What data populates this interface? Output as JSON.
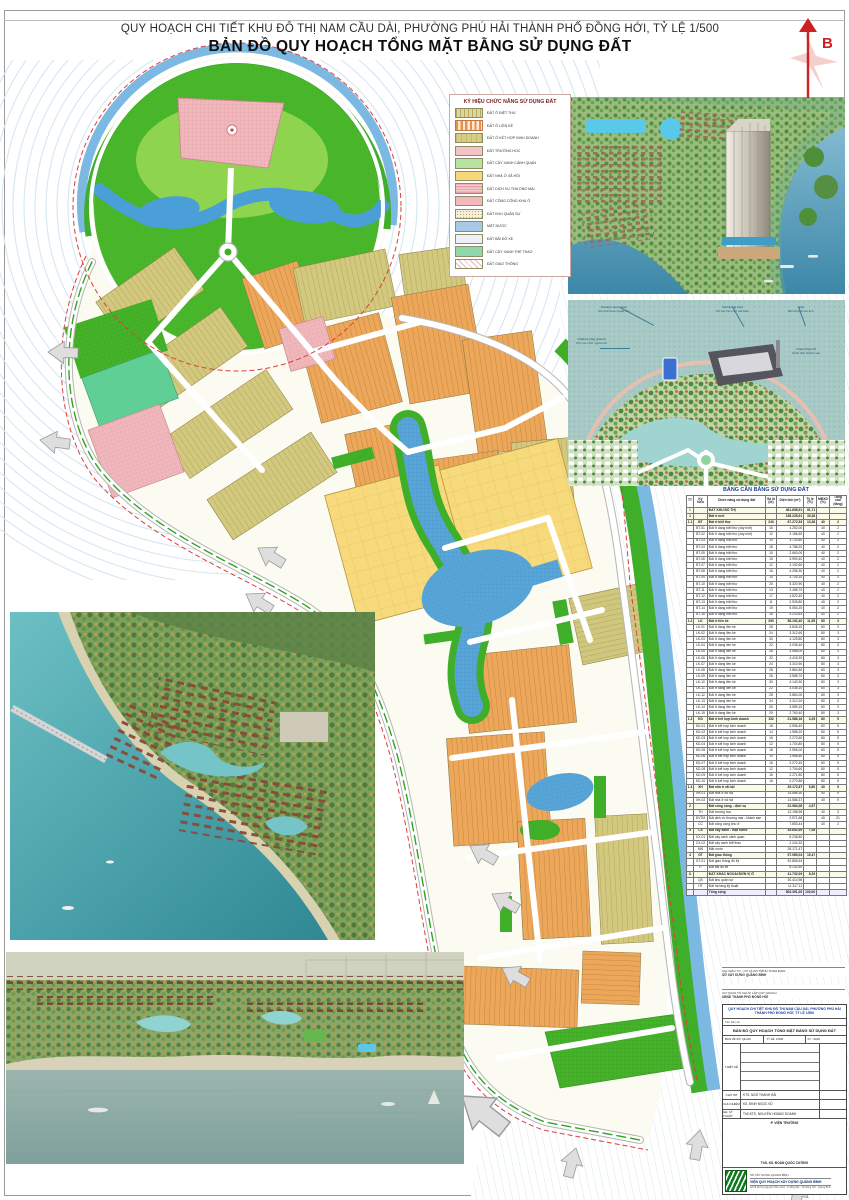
{
  "page": {
    "title_line1": "QUY HOẠCH CHI TIẾT KHU ĐÔ THỊ NAM CẦU DÀI, PHƯỜNG PHÚ HẢI THÀNH PHỐ ĐỒNG HỚI, TỶ LỆ 1/500",
    "title_line2": "BẢN ĐỒ QUY HOẠCH TỔNG MẶT BẰNG SỬ DỤNG ĐẤT",
    "north_label": "B"
  },
  "legend": {
    "title": "KÝ HIỆU CHỨC NĂNG SỬ DỤNG ĐẤT",
    "items": [
      {
        "label": "ĐẤT Ở BIỆT THỰ",
        "cls": "sw-bt",
        "color": "#ddd79c"
      },
      {
        "label": "ĐẤT Ở LIỀN KỀ",
        "cls": "sw-lk",
        "color": "#e8904a"
      },
      {
        "label": "ĐẤT Ở KẾT HỢP KINH DOANH",
        "cls": "sw-kd",
        "color": "#d9cd85"
      },
      {
        "label": "ĐẤT TRƯỜNG HỌC",
        "cls": "sw-th",
        "color": "#f3c3c6"
      },
      {
        "label": "ĐẤT CÂY XANH CẢNH QUAN",
        "cls": "sw-cx",
        "color": "#b9e3a2"
      },
      {
        "label": "ĐẤT NHÀ Ở XÃ HỘI",
        "cls": "sw-nx",
        "color": "#f6d87a"
      },
      {
        "label": "ĐẤT DỊCH VỤ THƯƠNG MẠI",
        "cls": "sw-dv",
        "color": "#eaa2aa"
      },
      {
        "label": "ĐẤT CÔNG CỘNG KHU Ở",
        "cls": "sw-cc",
        "color": "#f2b8bc"
      },
      {
        "label": "ĐẤT KHU QUÂN SỰ",
        "cls": "sw-qs",
        "color": "#f5efd9"
      },
      {
        "label": "MẶT NƯỚC",
        "cls": "sw-mn",
        "color": "#a9c9e9"
      },
      {
        "label": "ĐẤT BÃI ĐỖ XE",
        "cls": "sw-px",
        "color": "#eef0f8"
      },
      {
        "label": "ĐẤT CÂY XANH THỂ THAO",
        "cls": "sw-ct",
        "color": "#8fd8ab"
      },
      {
        "label": "ĐẤT GIAO THÔNG",
        "cls": "sw-gt",
        "color": "#e8b8b8"
      }
    ]
  },
  "land_use_table": {
    "title": "BẢNG CÂN BẰNG SỬ DỤNG ĐẤT",
    "columns": [
      "TT",
      "Ký hiệu",
      "Chức năng sử dụng đất",
      "Số lô (lô)",
      "Diện tích (m²)",
      "Tỷ lệ (%)",
      "MĐXD (%)",
      "Tầng cao (tầng)"
    ],
    "rows": [
      {
        "b": 1,
        "c": [
          "I",
          "",
          "ĐẤT KHU ĐÔ THỊ",
          "",
          "461.658,91",
          "91,71",
          "",
          ""
        ]
      },
      {
        "b": 1,
        "c": [
          "1",
          "",
          "Đất ở mới",
          "",
          "198.228,91",
          "39,38",
          "",
          ""
        ]
      },
      {
        "b": 1,
        "c": [
          "1.1",
          "BT",
          "Đất ở biệt thự",
          "243",
          "67.272,53",
          "13,36",
          "40",
          "2"
        ]
      },
      {
        "c": [
          "",
          "BT-01",
          "Đất ở dạng biệt thự (xây mới)",
          "16",
          "4.252,00",
          "",
          "40",
          "2"
        ]
      },
      {
        "c": [
          "",
          "BT-02",
          "Đất ở dạng biệt thự (xây mới)",
          "12",
          "3.186,50",
          "",
          "40",
          "2"
        ]
      },
      {
        "c": [
          "",
          "BT-03",
          "Đất ở dạng biệt thự",
          "14",
          "3.724,80",
          "",
          "40",
          "2"
        ]
      },
      {
        "c": [
          "",
          "BT-04",
          "Đất ở dạng biệt thự",
          "18",
          "4.788,20",
          "",
          "40",
          "2"
        ]
      },
      {
        "c": [
          "",
          "BT-05",
          "Đất ở dạng biệt thự",
          "10",
          "2.660,00",
          "",
          "40",
          "2"
        ]
      },
      {
        "c": [
          "",
          "BT-06",
          "Đất ở dạng biệt thự",
          "15",
          "3.990,40",
          "",
          "40",
          "2"
        ]
      },
      {
        "c": [
          "",
          "BT-07",
          "Đất ở dạng biệt thự",
          "12",
          "3.192,60",
          "",
          "40",
          "2"
        ]
      },
      {
        "c": [
          "",
          "BT-08",
          "Đất ở dạng biệt thự",
          "16",
          "4.256,30",
          "",
          "40",
          "2"
        ]
      },
      {
        "c": [
          "",
          "BT-09",
          "Đất ở dạng biệt thự",
          "14",
          "3.724,10",
          "",
          "40",
          "2"
        ]
      },
      {
        "c": [
          "",
          "BT-10",
          "Đất ở dạng biệt thự",
          "20",
          "5.320,90",
          "",
          "40",
          "2"
        ]
      },
      {
        "c": [
          "",
          "BT-11",
          "Đất ở dạng biệt thự",
          "13",
          "3.458,70",
          "",
          "40",
          "2"
        ]
      },
      {
        "c": [
          "",
          "BT-12",
          "Đất ở dạng biệt thự",
          "17",
          "4.522,40",
          "",
          "40",
          "2"
        ]
      },
      {
        "c": [
          "",
          "BT-13",
          "Đất ở dạng biệt thự",
          "11",
          "2.926,80",
          "",
          "40",
          "2"
        ]
      },
      {
        "c": [
          "",
          "BT-14",
          "Đất ở dạng biệt thự",
          "19",
          "5.054,20",
          "",
          "40",
          "2"
        ]
      },
      {
        "c": [
          "",
          "BT-15",
          "Đất ở dạng biệt thự",
          "16",
          "4.214,63",
          "",
          "40",
          "2"
        ]
      },
      {
        "b": 1,
        "c": [
          "1.2",
          "LK",
          "Đất ở liền kề",
          "390",
          "58.152,40",
          "11,55",
          "80",
          "3"
        ]
      },
      {
        "c": [
          "",
          "LK-01",
          "Đất ở dạng liền kề",
          "28",
          "3.845,20",
          "",
          "80",
          "3"
        ]
      },
      {
        "c": [
          "",
          "LK-02",
          "Đất ở dạng liền kề",
          "24",
          "3.312,60",
          "",
          "80",
          "3"
        ]
      },
      {
        "c": [
          "",
          "LK-03",
          "Đất ở dạng liền kề",
          "30",
          "4.125,80",
          "",
          "80",
          "3"
        ]
      },
      {
        "c": [
          "",
          "LK-04",
          "Đất ở dạng liền kề",
          "22",
          "3.036,40",
          "",
          "80",
          "3"
        ]
      },
      {
        "c": [
          "",
          "LK-05",
          "Đất ở dạng liền kề",
          "26",
          "3.588,00",
          "",
          "80",
          "3"
        ]
      },
      {
        "c": [
          "",
          "LK-06",
          "Đất ở dạng liền kề",
          "32",
          "4.416,20",
          "",
          "80",
          "3"
        ]
      },
      {
        "c": [
          "",
          "LK-07",
          "Đất ở dạng liền kề",
          "24",
          "3.310,90",
          "",
          "80",
          "3"
        ]
      },
      {
        "c": [
          "",
          "LK-08",
          "Đất ở dạng liền kề",
          "28",
          "3.864,50",
          "",
          "80",
          "3"
        ]
      },
      {
        "c": [
          "",
          "LK-09",
          "Đất ở dạng liền kề",
          "26",
          "3.588,70",
          "",
          "80",
          "3"
        ]
      },
      {
        "c": [
          "",
          "LK-10",
          "Đất ở dạng liền kề",
          "30",
          "4.140,30",
          "",
          "80",
          "3"
        ]
      },
      {
        "c": [
          "",
          "LK-11",
          "Đất ở dạng liền kề",
          "22",
          "3.036,10",
          "",
          "80",
          "3"
        ]
      },
      {
        "c": [
          "",
          "LK-12",
          "Đất ở dạng liền kề",
          "28",
          "3.864,00",
          "",
          "80",
          "3"
        ]
      },
      {
        "c": [
          "",
          "LK-13",
          "Đất ở dạng liền kề",
          "24",
          "3.312,20",
          "",
          "80",
          "3"
        ]
      },
      {
        "c": [
          "",
          "LK-14",
          "Đất ở dạng liền kề",
          "26",
          "3.589,10",
          "",
          "80",
          "3"
        ]
      },
      {
        "c": [
          "",
          "LK-15",
          "Đất ở dạng liền kề",
          "20",
          "2.760,40",
          "",
          "80",
          "3"
        ]
      },
      {
        "b": 1,
        "c": [
          "1.3",
          "KD",
          "Đất ở kết hợp kinh doanh",
          "152",
          "21.586,16",
          "4,29",
          "80",
          "5"
        ]
      },
      {
        "c": [
          "",
          "KD-01",
          "Đất ở kết hợp kinh doanh",
          "18",
          "2.556,40",
          "",
          "80",
          "5"
        ]
      },
      {
        "c": [
          "",
          "KD-02",
          "Đất ở kết hợp kinh doanh",
          "14",
          "1.988,20",
          "",
          "80",
          "5"
        ]
      },
      {
        "c": [
          "",
          "KD-03",
          "Đất ở kết hợp kinh doanh",
          "16",
          "2.272,60",
          "",
          "80",
          "5"
        ]
      },
      {
        "c": [
          "",
          "KD-04",
          "Đất ở kết hợp kinh doanh",
          "12",
          "1.704,80",
          "",
          "80",
          "5"
        ]
      },
      {
        "c": [
          "",
          "KD-05",
          "Đất ở kết hợp kinh doanh",
          "18",
          "2.556,00",
          "",
          "80",
          "5"
        ]
      },
      {
        "c": [
          "",
          "KD-06",
          "Đất ở kết hợp kinh doanh",
          "14",
          "1.988,50",
          "",
          "80",
          "5"
        ]
      },
      {
        "c": [
          "",
          "KD-07",
          "Đất ở kết hợp kinh doanh",
          "16",
          "2.272,40",
          "",
          "80",
          "5"
        ]
      },
      {
        "c": [
          "",
          "KD-08",
          "Đất ở kết hợp kinh doanh",
          "12",
          "1.704,60",
          "",
          "80",
          "5"
        ]
      },
      {
        "c": [
          "",
          "KD-09",
          "Đất ở kết hợp kinh doanh",
          "16",
          "2.271,80",
          "",
          "80",
          "5"
        ]
      },
      {
        "c": [
          "",
          "KD-10",
          "Đất ở kết hợp kinh doanh",
          "16",
          "2.270,86",
          "",
          "80",
          "5"
        ]
      },
      {
        "b": 1,
        "c": [
          "1.4",
          "XH",
          "Đất nhà ở xã hội",
          "",
          "29.172,67",
          "5,80",
          "40",
          "9"
        ]
      },
      {
        "c": [
          "",
          "XH-01",
          "Đất nhà ở xã hội",
          "",
          "14.586,30",
          "",
          "40",
          "9"
        ]
      },
      {
        "c": [
          "",
          "XH-02",
          "Đất nhà ở xã hội",
          "",
          "14.586,37",
          "",
          "40",
          "9"
        ]
      },
      {
        "b": 1,
        "c": [
          "2",
          "",
          "Đất công cộng - dịch vụ",
          "",
          "22.984,08",
          "4,57",
          "",
          ""
        ]
      },
      {
        "c": [
          "",
          "TH",
          "Đất trường học",
          "",
          "12.158,96",
          "",
          "40",
          "3"
        ]
      },
      {
        "c": [
          "",
          "DVTM",
          "Đất dịch vụ thương mại - khách sạn",
          "",
          "2.971,68",
          "",
          "40",
          "21"
        ]
      },
      {
        "c": [
          "",
          "CC",
          "Đất công cộng khu ở",
          "",
          "7.853,44",
          "",
          "40",
          "2"
        ]
      },
      {
        "b": 1,
        "c": [
          "3",
          "CX",
          "Đất cây xanh - mặt nước",
          "",
          "35.652,59",
          "7,08",
          "",
          ""
        ]
      },
      {
        "c": [
          "",
          "CX-01",
          "Đất cây xanh cảnh quan",
          "",
          "5.236,80",
          "",
          "",
          ""
        ]
      },
      {
        "c": [
          "",
          "CX-02",
          "Đất cây xanh thể thao",
          "",
          "2.244,32",
          "",
          "",
          ""
        ]
      },
      {
        "c": [
          "",
          "MN",
          "Mặt nước",
          "",
          "28.171,47",
          "",
          "",
          ""
        ]
      },
      {
        "b": 1,
        "c": [
          "4",
          "GT",
          "Đất giao thông",
          "",
          "97.989,04",
          "19,47",
          "",
          ""
        ]
      },
      {
        "c": [
          "",
          "GT-01",
          "Đất giao thông đô thị",
          "",
          "92.856,54",
          "",
          "",
          ""
        ]
      },
      {
        "c": [
          "",
          "P",
          "Đất bãi đỗ xe",
          "",
          "5.132,50",
          "",
          "",
          ""
        ]
      },
      {
        "b": 1,
        "c": [
          "II",
          "",
          "ĐẤT KHÁC NGOÀI ĐƠN VỊ Ở",
          "",
          "41.732,09",
          "8,29",
          "",
          ""
        ]
      },
      {
        "c": [
          "",
          "QS",
          "Đất khu quân sự",
          "",
          "30.414,98",
          "",
          "",
          ""
        ]
      },
      {
        "c": [
          "",
          "HT",
          "Đất hạ tầng kỹ thuật",
          "",
          "11.317,11",
          "",
          "",
          ""
        ]
      }
    ],
    "footer": [
      "",
      "",
      "Tổng cộng",
      "",
      "503.391,00",
      "100,00",
      "",
      ""
    ]
  },
  "render2": {
    "annotations": [
      {
        "en": "Outdoor sport area",
        "vi": "Khu thể thao ngoài trời"
      },
      {
        "en": "Outdoor play ground",
        "vi": "Khu vui chơi ngoài trời"
      },
      {
        "en": "Swimming pool",
        "vi": "Hồ bơi trên cao sát biển"
      },
      {
        "en": "Jetty",
        "vi": "Bến thuyền du lịch"
      },
      {
        "en": "Hotel Drop-off",
        "vi": "Sảnh đón khách sạn"
      }
    ]
  },
  "approval": {
    "s1_label": "CHỦ ĐẦU TƯ - CƠ QUAN TRÌNH THẨM ĐỊNH:",
    "s1_value": "SỞ XÂY DỰNG QUẢNG BÌNH",
    "s2_label": "CƠ QUAN TỔ CHỨC LẬP QUY HOẠCH:",
    "s2_value": "UBND THÀNH PHỐ ĐỒNG HỚI",
    "sig_hint": "(Ký tên)        (Chức vụ)        (Đóng dấu)"
  },
  "title_block": {
    "project_line1": "QUY HOẠCH CHI TIẾT KHU ĐÔ THỊ NAM CẦU DÀI, PHƯỜNG PHÚ HẢI",
    "project_line2": "THÀNH PHỐ ĐỒNG HỚI, TỶ LỆ 1/500",
    "drawing_label": "Tên bản vẽ:",
    "drawing_name": "BẢN ĐỒ QUY HOẠCH TỔNG MẶT BẰNG SỬ DỤNG ĐẤT",
    "sheet_label": "BẢN VẼ SỐ: QH-06",
    "scale_label": "TỶ LỆ: 1/500",
    "date_label": "07 - 2018",
    "thiet_ke_label": "THIẾT KẾ",
    "designers": [
      "KTS. NGUYỄN THỊ DIỆU LAN",
      "KTS. NGUYỄN LÊ DƯƠNG",
      "KTS. LÝ QUANG MINH",
      "KTS. NGUYỄN VIỆT HOÀNG",
      "KTS. ĐINH THỊ BÍCH NGỌC"
    ],
    "chu_tri_label": "CHỦ TRÌ",
    "chu_tri": "KTS. NGÔ THANH HẢI",
    "chu_nhiem_label": "CHỦ NHIỆM",
    "chu_nhiem": "KS. ĐINH NGỌC VŨ",
    "gd_kt_label": "GĐ. KỸ THUẬT",
    "gd_kt": "ThS.KTS. NGUYỄN HOÀNG DOANH",
    "vien_truong_title": "P. VIỆN TRƯỞNG",
    "vien_truong_name": "ThS. KS. ĐOÀN QUỐC CƯỜNG",
    "org_small": "SỞ XÂY DỰNG QUẢNG BÌNH",
    "org_name": "VIỆN QUY HOẠCH XÂY DỰNG QUẢNG BÌNH",
    "org_address": "Số 05 Đường Nguyễn Hữu Cảnh - P. Đồng Mỹ - TP. Đồng Hới - Quảng Bình"
  }
}
